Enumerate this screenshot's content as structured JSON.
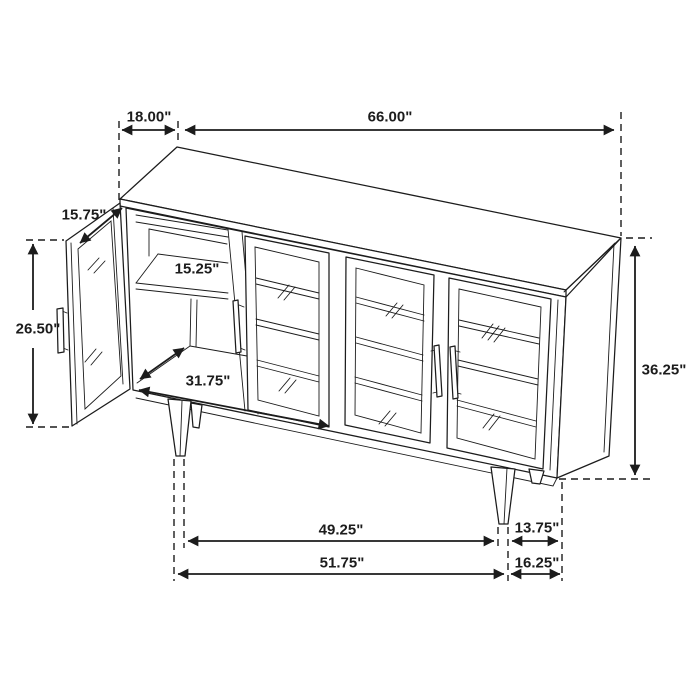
{
  "page": {
    "background": "#ffffff",
    "line_color": "#1c1c1c",
    "description": "Dimension line drawing of a 4-door sideboard cabinet with one glass door open"
  },
  "drawing": {
    "unit": "inches",
    "dimensions": {
      "top_depth": "18.00\"",
      "top_width": "66.00\"",
      "open_door_width": "15.75\"",
      "open_door_height": "26.50\"",
      "shelf_depth": "15.25\"",
      "interior_width": "31.75\"",
      "overall_height": "36.25\"",
      "inner_leg_span": "49.25\"",
      "leg_to_corner_upper": "13.75\"",
      "outer_leg_span": "51.75\"",
      "leg_to_corner_lower": "16.25\""
    }
  }
}
